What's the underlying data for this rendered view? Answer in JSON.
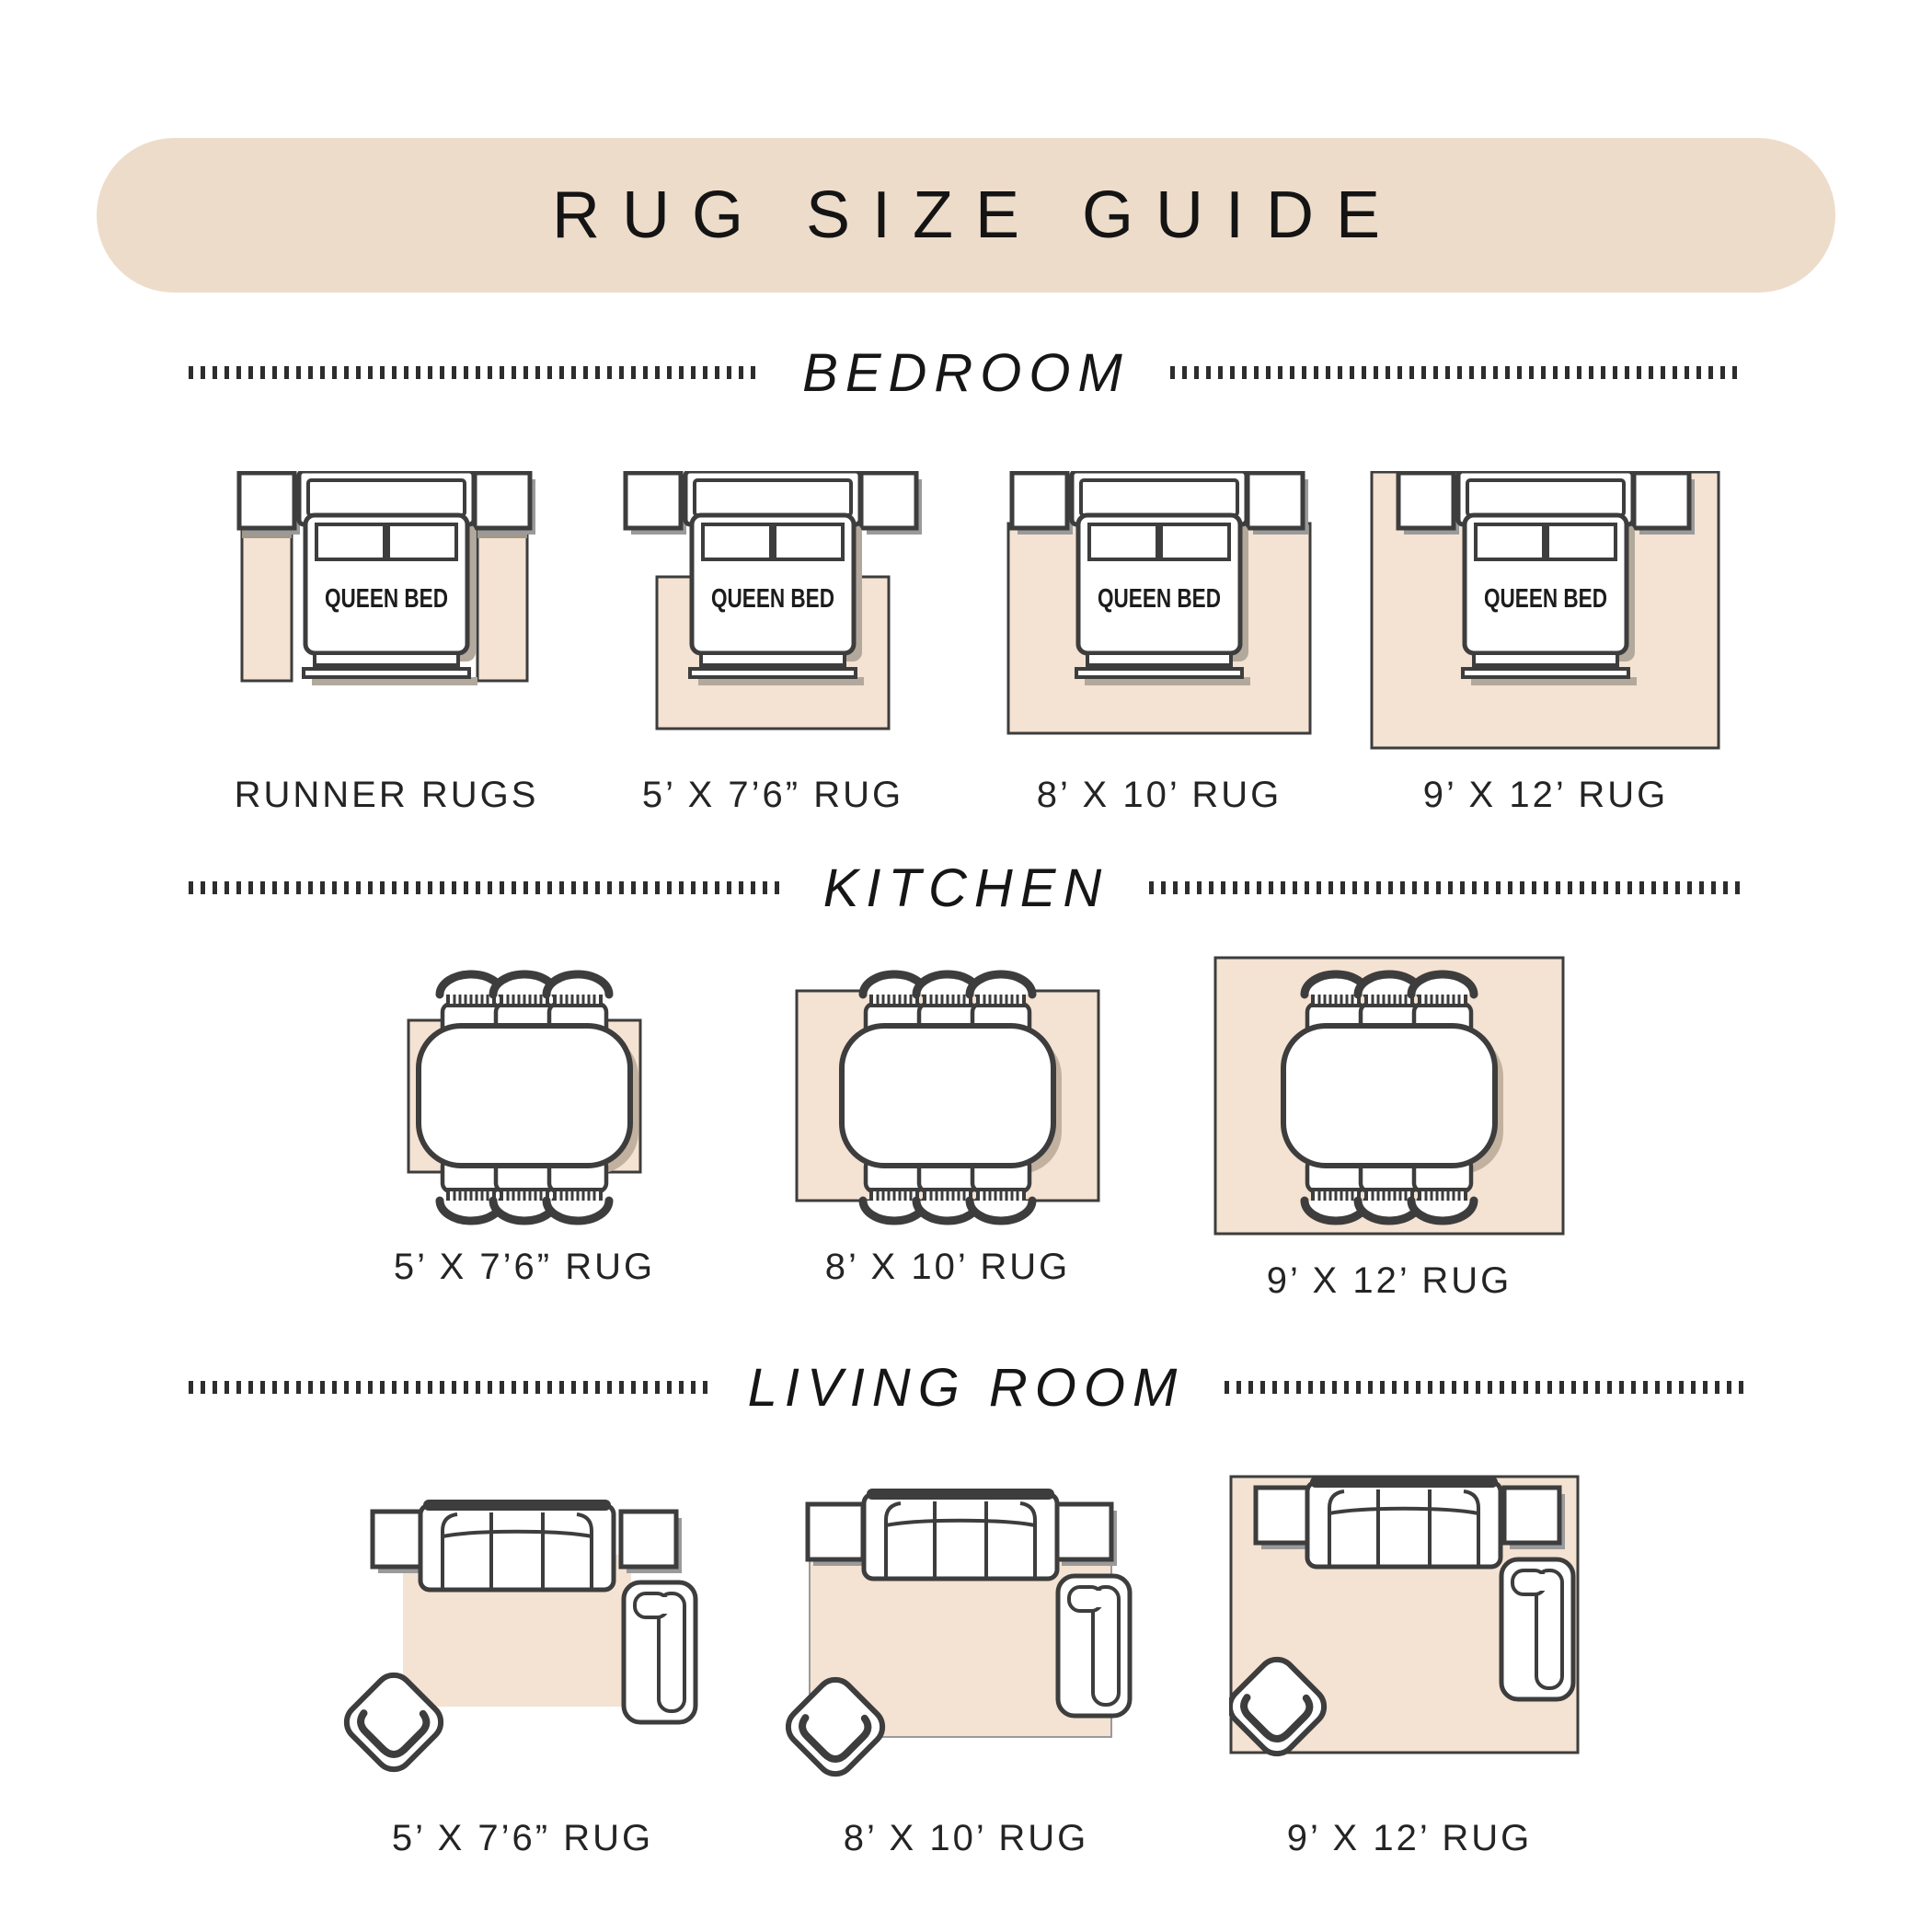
{
  "header": {
    "title": "RUG SIZE GUIDE"
  },
  "bed_label": "QUEEN BED",
  "sections": {
    "bedroom": {
      "title": "BEDROOM",
      "figures": [
        {
          "label": "RUNNER RUGS"
        },
        {
          "label": "5’ X 7’6” RUG"
        },
        {
          "label": "8’ X 10’ RUG"
        },
        {
          "label": "9’ X 12’ RUG"
        }
      ]
    },
    "kitchen": {
      "title": "KITCHEN",
      "figures": [
        {
          "label": "5’ X 7’6” RUG"
        },
        {
          "label": "8’ X 10’ RUG"
        },
        {
          "label": "9’ X 12’ RUG"
        }
      ]
    },
    "living_room": {
      "title": "LIVING ROOM",
      "figures": [
        {
          "label": "5’ X 7’6” RUG"
        },
        {
          "label": "8’ X 10’ RUG"
        },
        {
          "label": "9’ X 12’ RUG"
        }
      ]
    }
  },
  "colors": {
    "banner": "#eedccb",
    "rug": "#f4e2d2",
    "outline": "#3d3d3d",
    "shadow": "#b2a99c",
    "text": "#1f1f1f"
  }
}
